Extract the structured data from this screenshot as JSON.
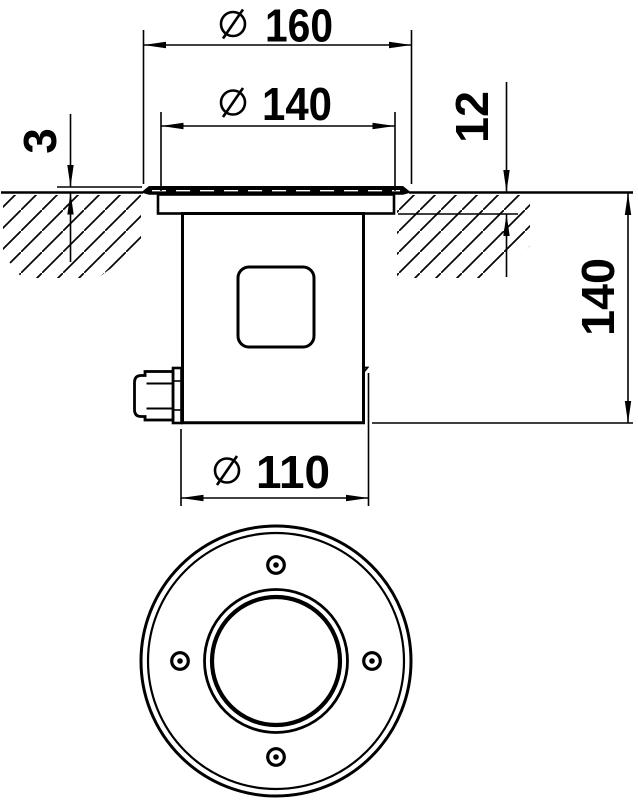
{
  "drawing": {
    "dimensions": {
      "bezel_diameter": "160",
      "flange_diameter": "140",
      "protrusion": "3",
      "flange_depth": "12",
      "installation_depth": "140",
      "housing_diameter": "110"
    },
    "diameter_symbol": "⌀",
    "colors": {
      "ink": "#000000",
      "paper": "#ffffff"
    }
  }
}
